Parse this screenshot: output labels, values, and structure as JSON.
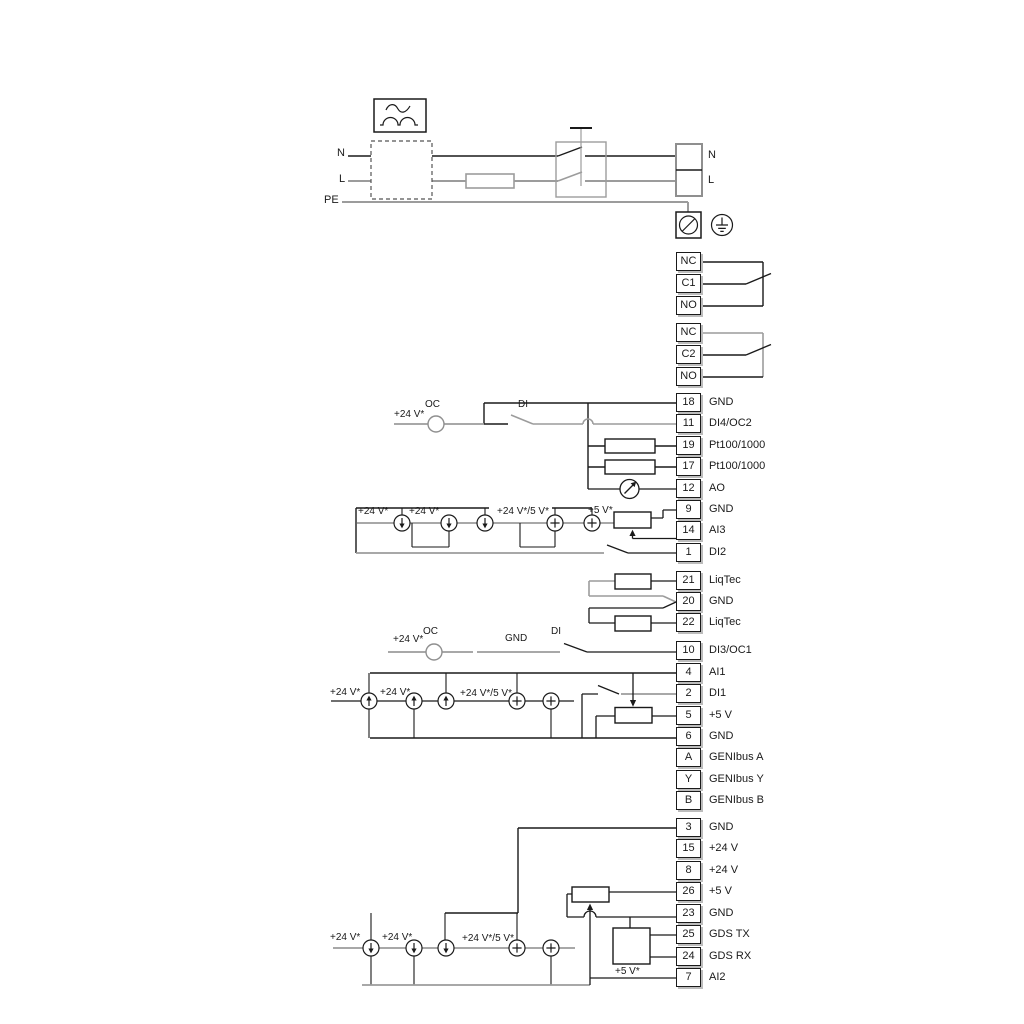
{
  "power": {
    "n": "N",
    "l": "L",
    "pe": "PE",
    "n_right": "N",
    "l_right": "L"
  },
  "relays": [
    {
      "cells": [
        "NC",
        "C1",
        "NO"
      ]
    },
    {
      "cells": [
        "NC",
        "C2",
        "NO"
      ]
    }
  ],
  "terminals": [
    {
      "id": "18",
      "label": "GND"
    },
    {
      "id": "11",
      "label": "DI4/OC2"
    },
    {
      "id": "19",
      "label": "Pt100/1000"
    },
    {
      "id": "17",
      "label": "Pt100/1000"
    },
    {
      "id": "12",
      "label": "AO"
    },
    {
      "id": "9",
      "label": "GND"
    },
    {
      "id": "14",
      "label": "AI3"
    },
    {
      "id": "1",
      "label": "DI2"
    },
    {
      "id": "21",
      "label": "LiqTec"
    },
    {
      "id": "20",
      "label": "GND"
    },
    {
      "id": "22",
      "label": "LiqTec"
    },
    {
      "id": "10",
      "label": "DI3/OC1"
    },
    {
      "id": "4",
      "label": "AI1"
    },
    {
      "id": "2",
      "label": "DI1"
    },
    {
      "id": "5",
      "label": "+5 V"
    },
    {
      "id": "6",
      "label": "GND"
    },
    {
      "id": "A",
      "label": "GENIbus A"
    },
    {
      "id": "Y",
      "label": "GENIbus Y"
    },
    {
      "id": "B",
      "label": "GENIbus B"
    },
    {
      "id": "3",
      "label": "GND"
    },
    {
      "id": "15",
      "label": "+24 V"
    },
    {
      "id": "8",
      "label": "+24 V"
    },
    {
      "id": "26",
      "label": "+5 V"
    },
    {
      "id": "23",
      "label": "GND"
    },
    {
      "id": "25",
      "label": "GDS TX"
    },
    {
      "id": "24",
      "label": "GDS RX"
    },
    {
      "id": "7",
      "label": "AI2"
    }
  ],
  "ann": {
    "v24": "+24 V*",
    "v24_5": "+24 V*/5 V*",
    "v5": "+5 V*",
    "oc": "OC",
    "di": "DI",
    "gnd": "GND"
  },
  "colors": {
    "wire_black": "#1a1a1a",
    "wire_gray": "#9c9c9c"
  }
}
